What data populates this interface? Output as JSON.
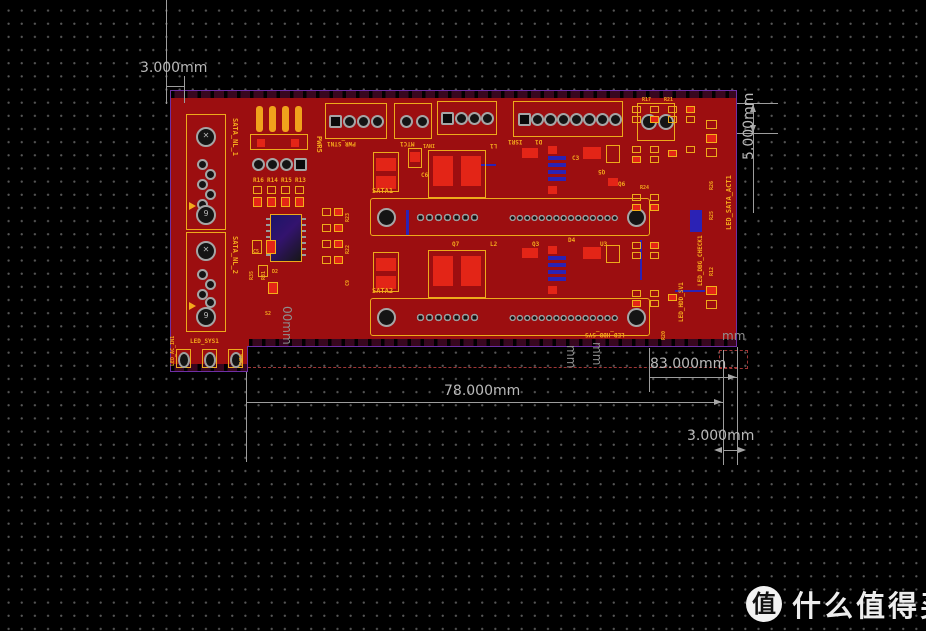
{
  "canvas": {
    "background": "#000000",
    "grid_dot_color": "#575757"
  },
  "colors": {
    "board_fill": "#9c0e10",
    "board_outline": "#6e2fa5",
    "component_red": "#e32517",
    "silk": "#f4a81c",
    "inner_blue": "#2b22b5",
    "dimension_gray": "#b9b9b9",
    "dashed_red": "#a03636"
  },
  "dimensions": {
    "top_left": "3.000mm",
    "right_height": "5.000mm",
    "width_inner": "78.000mm",
    "width_total": "83.000mm",
    "bottom_right": "3.000mm",
    "fragment_left": "00mm",
    "fragment_mid_a": "mm",
    "fragment_mid_b": "mm",
    "fragment_corner": "mm"
  },
  "board": {
    "pad_marks": {
      "cross": "✕",
      "nine": "9"
    },
    "connectors": {
      "sata_nl_1": "SATA_NL_1",
      "sata_nl_2": "SATA_NL_2",
      "sata1": "SATA1",
      "sata2": "SATA2",
      "pwr_stn1": "PWR_STN1",
      "mtc1": "MTC1",
      "isr1": "ISR1",
      "pwr5": "PWR5",
      "pwr4": "PWR4"
    },
    "leds": {
      "led_sys1": "LED_SYS1",
      "led_ac_in1": "LED_AC_IN1",
      "led_sata_act1": "LED_SATA_ACT1",
      "led_dbg_check1": "LED_DBG_CHECK1",
      "led_hdd_sv1": "LED_HDD_SV1",
      "led_hdd_sys": "LED_HDD_SYS"
    },
    "refs": {
      "r16": "R16",
      "r14": "R14",
      "r15": "R15",
      "r13": "R13",
      "r17": "R17",
      "r21": "R21",
      "r24": "R24",
      "r12": "R12",
      "r25": "R25",
      "r26": "R26",
      "r20": "R20",
      "r22": "R22",
      "r23": "R23",
      "r31": "R31",
      "r35": "R35",
      "c3": "C3",
      "c5": "C5",
      "c6": "C6",
      "c9": "C9",
      "d1": "D1",
      "d2": "D2",
      "d4": "D4",
      "q3": "Q3",
      "q5": "Q5",
      "q6": "Q6",
      "q7": "Q7",
      "u3": "U3",
      "l1": "L1",
      "l2": "L2",
      "s2": "S2",
      "inv1": "INV1"
    }
  },
  "watermark": {
    "logo_char": "值",
    "site_name": "什么值得买"
  }
}
